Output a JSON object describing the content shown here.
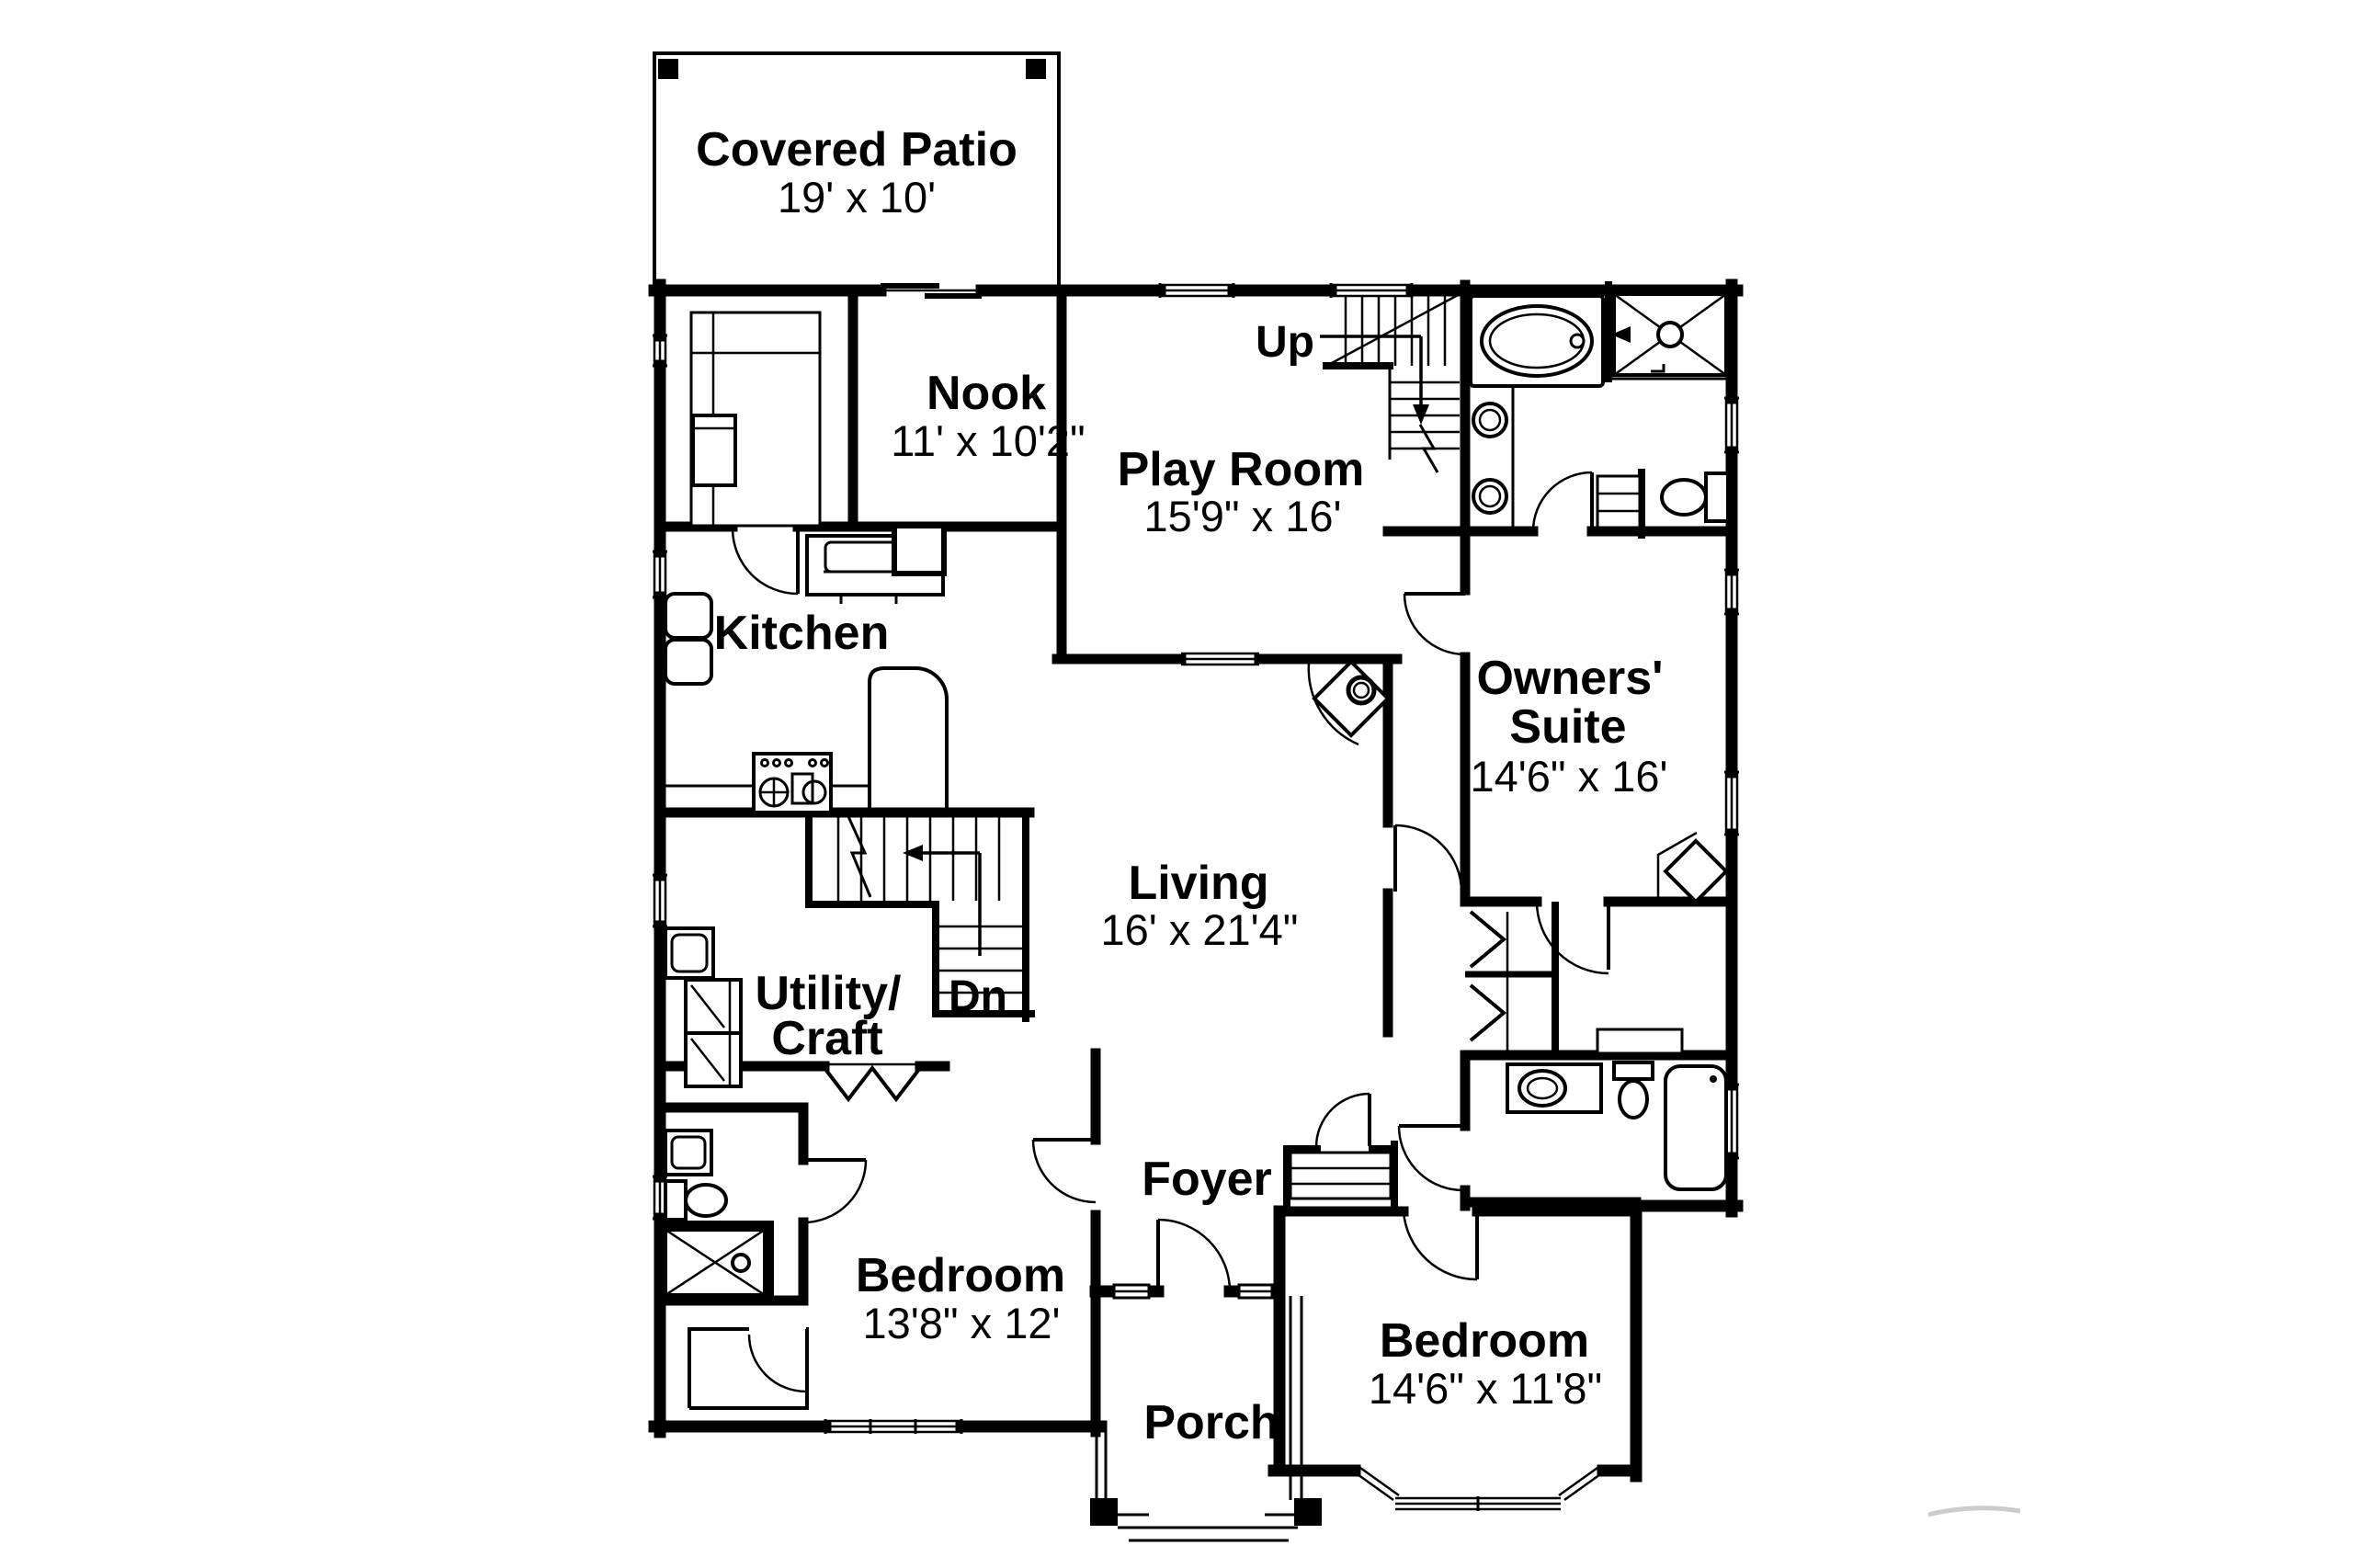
{
  "document": {
    "type": "floor-plan-drawing",
    "background_color": "#ffffff",
    "line_color": "#000000"
  },
  "labels": {
    "covered_patio": {
      "name": "Covered Patio",
      "dims": "19' x 10'"
    },
    "nook": {
      "name": "Nook",
      "dims": "11' x 10'2\""
    },
    "play_room": {
      "name": "Play Room",
      "dims": "15'9\" x 16'"
    },
    "kitchen": {
      "name": "Kitchen"
    },
    "owners_suite": {
      "line1": "Owners'",
      "line2": "Suite",
      "dims": "14'6\" x 16'"
    },
    "living": {
      "name": "Living",
      "dims": "16' x 21'4\""
    },
    "utility": {
      "line1": "Utility/",
      "line2": "Craft"
    },
    "foyer": {
      "name": "Foyer"
    },
    "bedroom_left": {
      "name": "Bedroom",
      "dims": "13'8\" x 12'"
    },
    "porch": {
      "name": "Porch"
    },
    "bedroom_right": {
      "name": "Bedroom",
      "dims": "14'6\" x 11'8\""
    }
  },
  "stairs": {
    "up": "Up",
    "down": "Dn"
  }
}
